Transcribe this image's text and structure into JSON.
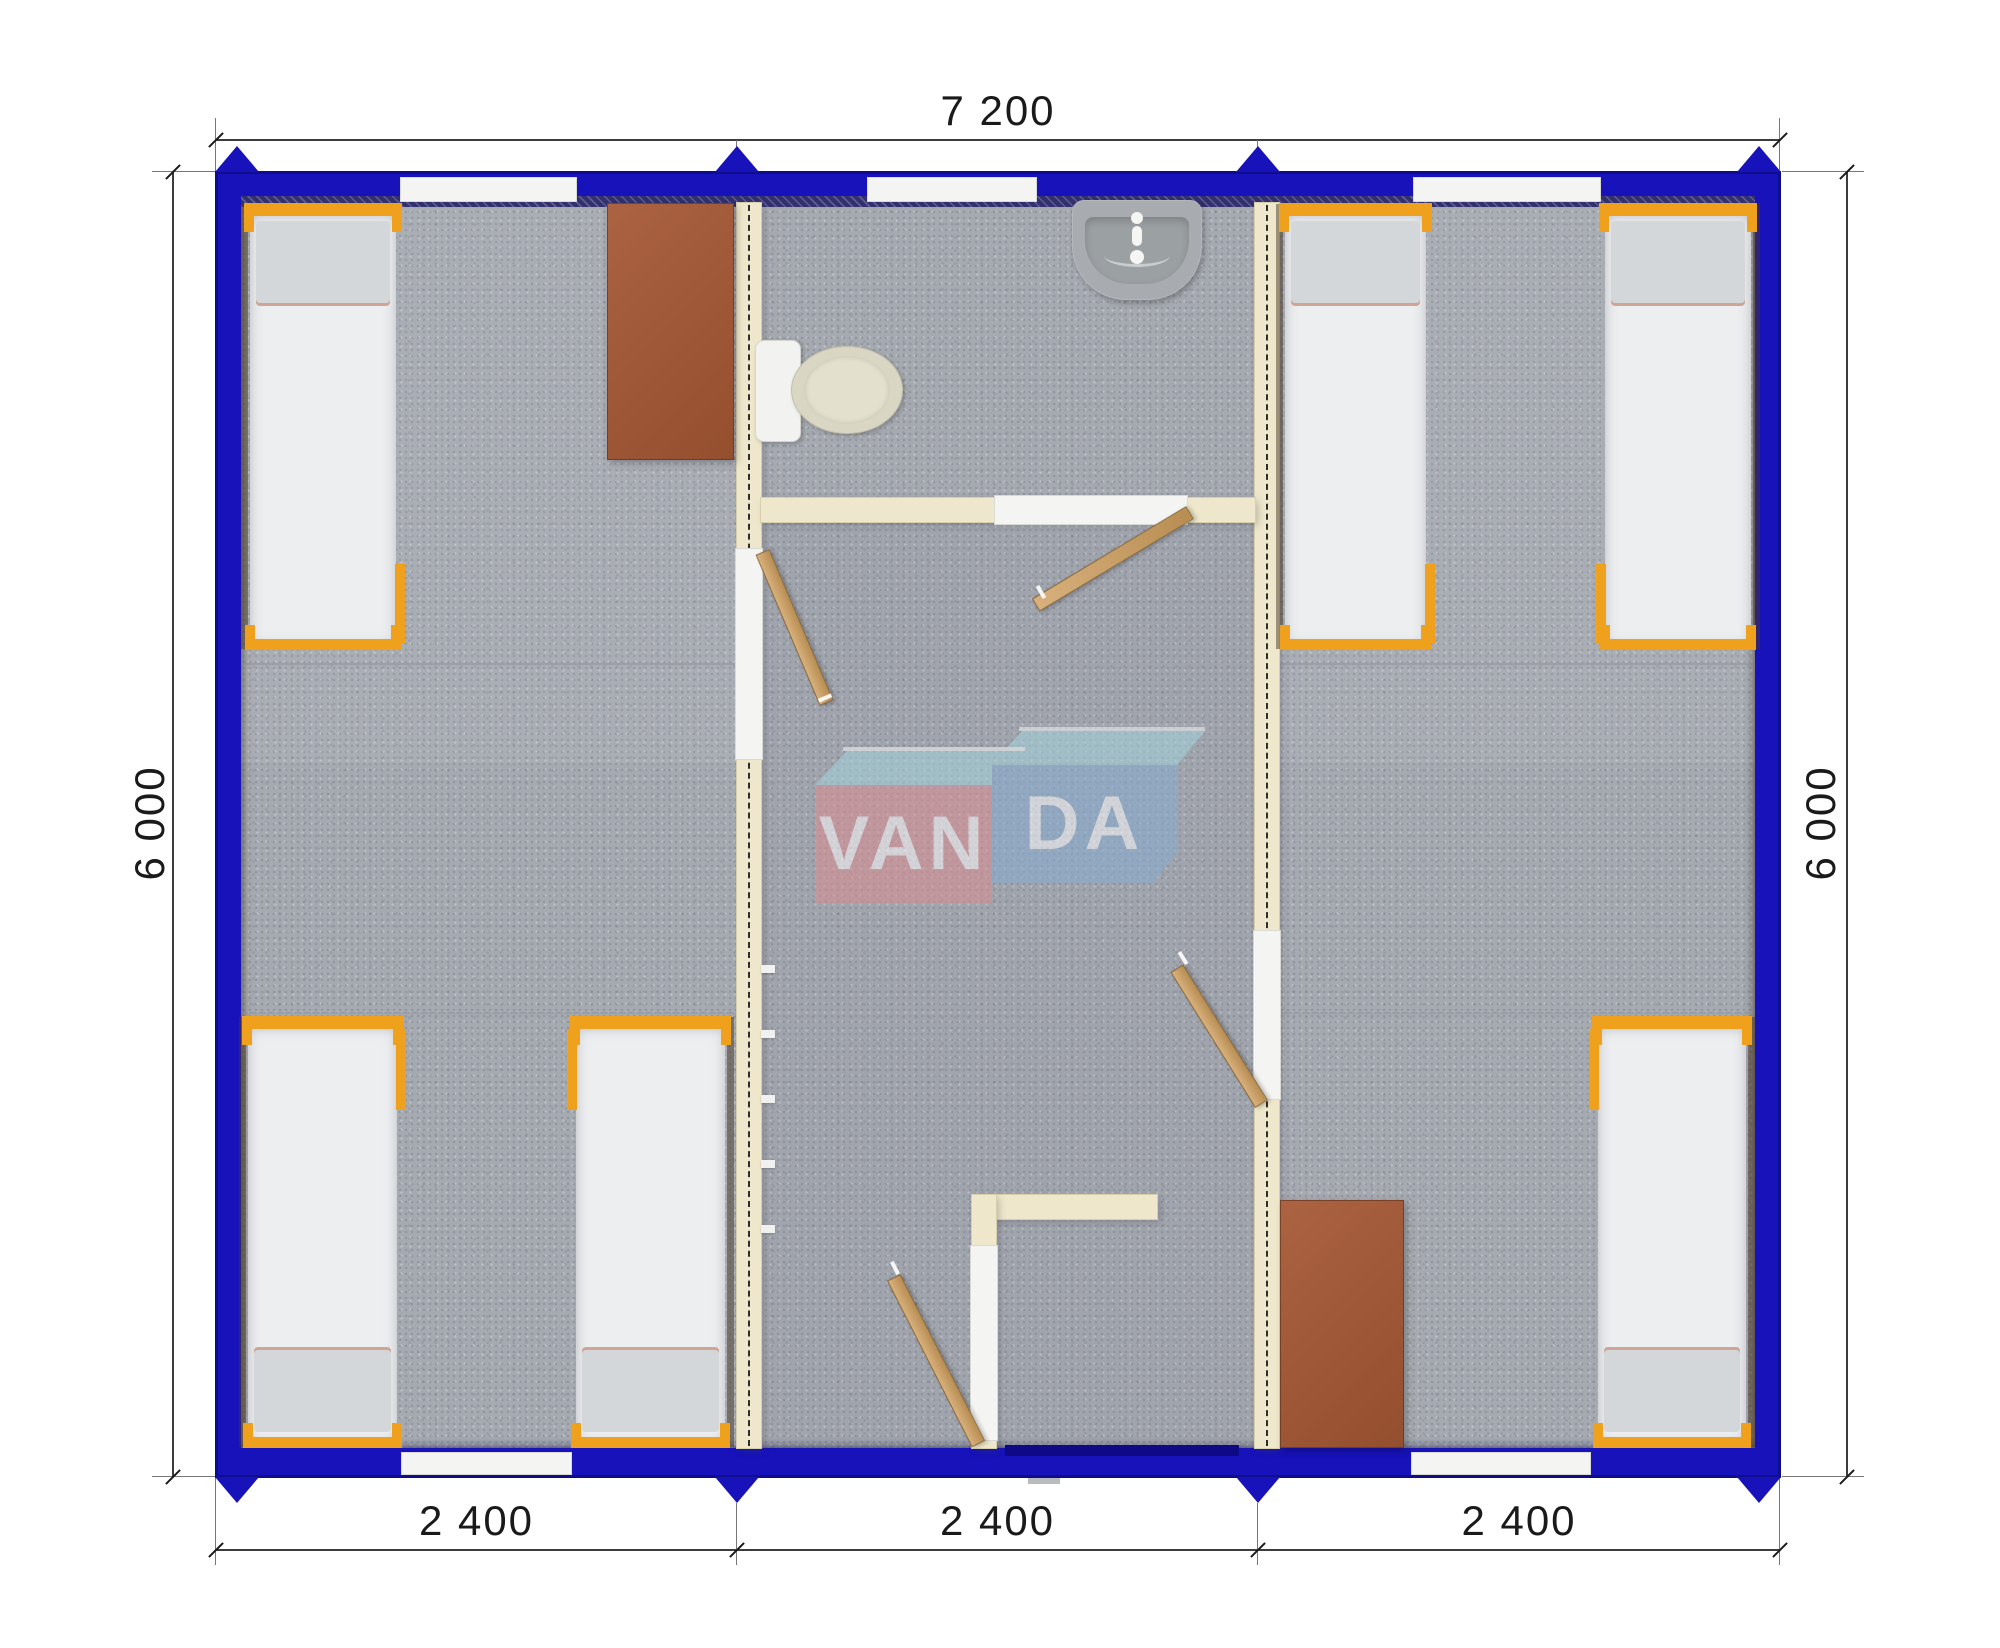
{
  "dimensions": {
    "top": "7 200",
    "left": "6 000",
    "right": "6 000",
    "bottom": [
      "2 400",
      "2 400",
      "2 400"
    ]
  },
  "watermark": {
    "brand": "VANDA",
    "block_left": "VAN",
    "block_right": "DA"
  },
  "colors": {
    "wall": "#1712b9",
    "wall_band": "#32306e",
    "carpet": "#a5a9b0",
    "partition": "#eee7cb",
    "partition_edge": "#d8cfae",
    "opening": "#f4f5f2",
    "bed_frame": "#efa11d",
    "mattress": "#eceef0",
    "pillow": "#d3d7d9",
    "table": "#a25b3c",
    "door_wood": "#cda46f",
    "toilet": "#d9d6c3",
    "sink": "#a8acb0",
    "logo_red": "#dd8d94",
    "logo_blue": "#87add2",
    "logo_top": "#a3d2dc",
    "dim_line": "#3c3c3c",
    "dim_text": "#1a1a1a"
  }
}
